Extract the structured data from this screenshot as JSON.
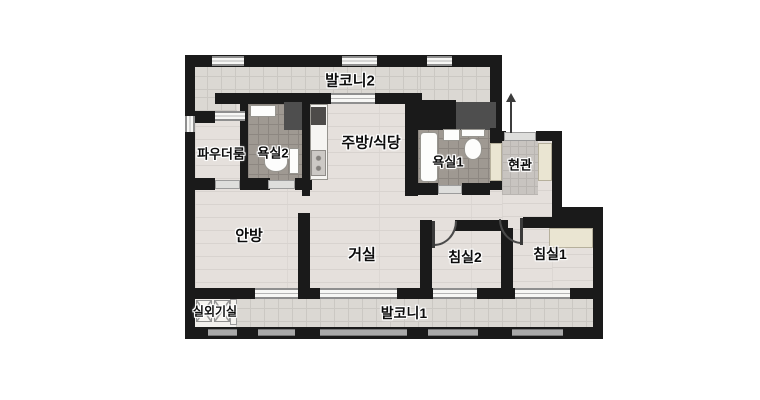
{
  "plan": {
    "rooms": {
      "balcony2": {
        "label": "발코니2"
      },
      "powder_room": {
        "label": "파우더룸"
      },
      "bathroom2": {
        "label": "욕실2"
      },
      "kitchen_dining": {
        "label": "주방/식당"
      },
      "bathroom1": {
        "label": "욕실1"
      },
      "entrance": {
        "label": "현관"
      },
      "master_bedroom": {
        "label": "안방"
      },
      "living_room": {
        "label": "거실"
      },
      "bedroom2": {
        "label": "침실2"
      },
      "bedroom1": {
        "label": "침실1"
      },
      "outdoor_unit_room": {
        "label": "실외기실"
      },
      "balcony1": {
        "label": "발코니1"
      }
    },
    "colors": {
      "background": "#ffffff",
      "wall": "#1a1a1a",
      "wood_floor": "#e5e0dc",
      "balcony_tile": "#dbd8d3",
      "bathroom_tile": "#9f9992",
      "entrance_tile": "#c8c4c0",
      "closet": "#eae5d2",
      "shaft": "#4e4e4e",
      "window_frame": "#8f8f8f"
    },
    "icons": [
      "toilet-icon",
      "sink-icon",
      "bathtub-icon",
      "range-hood-icon",
      "stove-icon",
      "kitchen-counter-icon",
      "shoe-closet-icon",
      "wardrobe-icon",
      "louver-vent-icon",
      "entrance-arrow-icon",
      "door-swing-icon",
      "window-symbol-icon"
    ]
  }
}
